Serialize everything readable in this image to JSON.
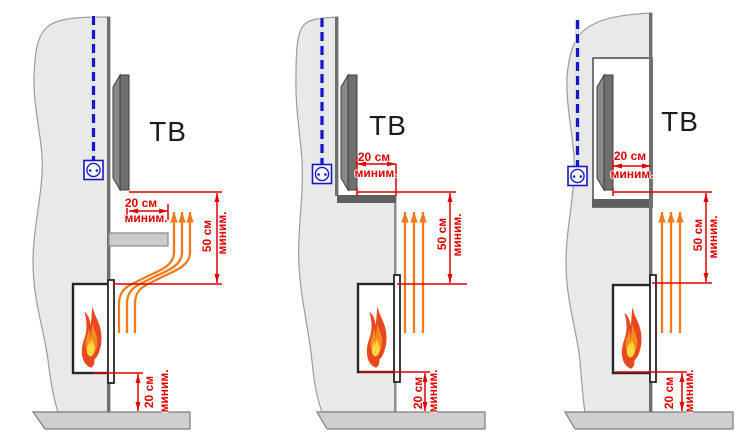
{
  "colors": {
    "dimension_red": "#de0000",
    "heat_orange": "#f07a1c",
    "cable_blue": "#1616c8",
    "wall_gray": "#e9e9e9",
    "slab_gray": "#cfcfcf",
    "tv_gray": "#6f6f6f"
  },
  "icons": {
    "outlet": "power-socket-icon",
    "cable": "dashed-cable-line",
    "flame": "flame-icon",
    "heat_flow": "up-arrows-icon"
  },
  "panels": [
    {
      "variant": "tv-on-wall-with-protective-shelf",
      "tv_label": "ТВ",
      "dims": {
        "tv_offset": {
          "value": "20 см",
          "qualifier": "миним."
        },
        "above_fireplace": {
          "value": "50 см",
          "qualifier": "миним."
        },
        "under_fireplace": {
          "value": "20 см",
          "qualifier": "миним."
        }
      }
    },
    {
      "variant": "tv-recessed-behind-fireplace-ledge",
      "tv_label": "ТВ",
      "dims": {
        "tv_offset": {
          "value": "20 см",
          "qualifier": "миним."
        },
        "above_fireplace": {
          "value": "50 см",
          "qualifier": "миним."
        },
        "under_fireplace": {
          "value": "20 см",
          "qualifier": "миним."
        }
      }
    },
    {
      "variant": "tv-in-wall-niche",
      "tv_label": "ТВ",
      "dims": {
        "tv_offset": {
          "value": "20 см",
          "qualifier": "миним."
        },
        "above_fireplace": {
          "value": "50 см",
          "qualifier": "миним."
        },
        "under_fireplace": {
          "value": "20 см",
          "qualifier": "миним."
        }
      }
    }
  ]
}
